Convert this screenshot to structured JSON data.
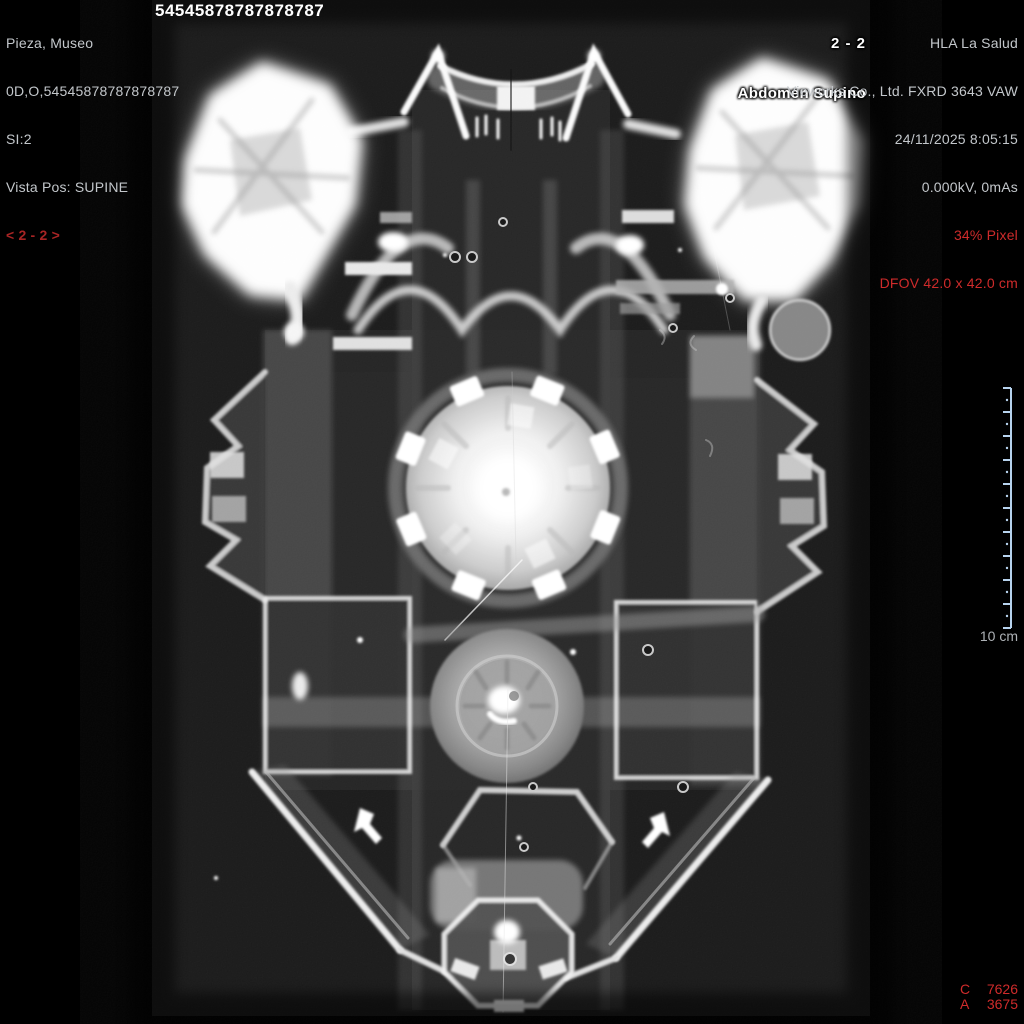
{
  "viewer": {
    "patient": {
      "name": "Pieza, Museo",
      "id_line": "0D,O,54545878787878787",
      "series_line": "SI:2",
      "view_position": "Vista Pos: SUPINE",
      "series_nav": "< 2 - 2 >"
    },
    "accession_number": "54545878787878787",
    "image_header": {
      "series_indicator": "2 - 2",
      "study_description": "Abdomen Supino"
    },
    "device": {
      "institution": "HLA La Salud",
      "model": "Vieworks Co., Ltd. FXRD 3643 VAW",
      "datetime": "24/11/2025 8:05:15",
      "exposure": "0.000kV, 0mAs",
      "pixel_zoom": "34% Pixel",
      "dfov": "DFOV 42.0 x 42.0 cm"
    },
    "scale_ruler": {
      "label": "10 cm",
      "units_cm": 10
    },
    "window_values": {
      "c_label": "C",
      "c_value": "7626",
      "a_label": "A",
      "a_value": "3675"
    },
    "colors": {
      "text_gray": "#c3c7cb",
      "text_red": "#cf2b2b",
      "nav_red": "#a82424",
      "ruler_blue": "#b7d3ee",
      "bold_white": "#ffffff",
      "field_bg": "#181818"
    }
  }
}
